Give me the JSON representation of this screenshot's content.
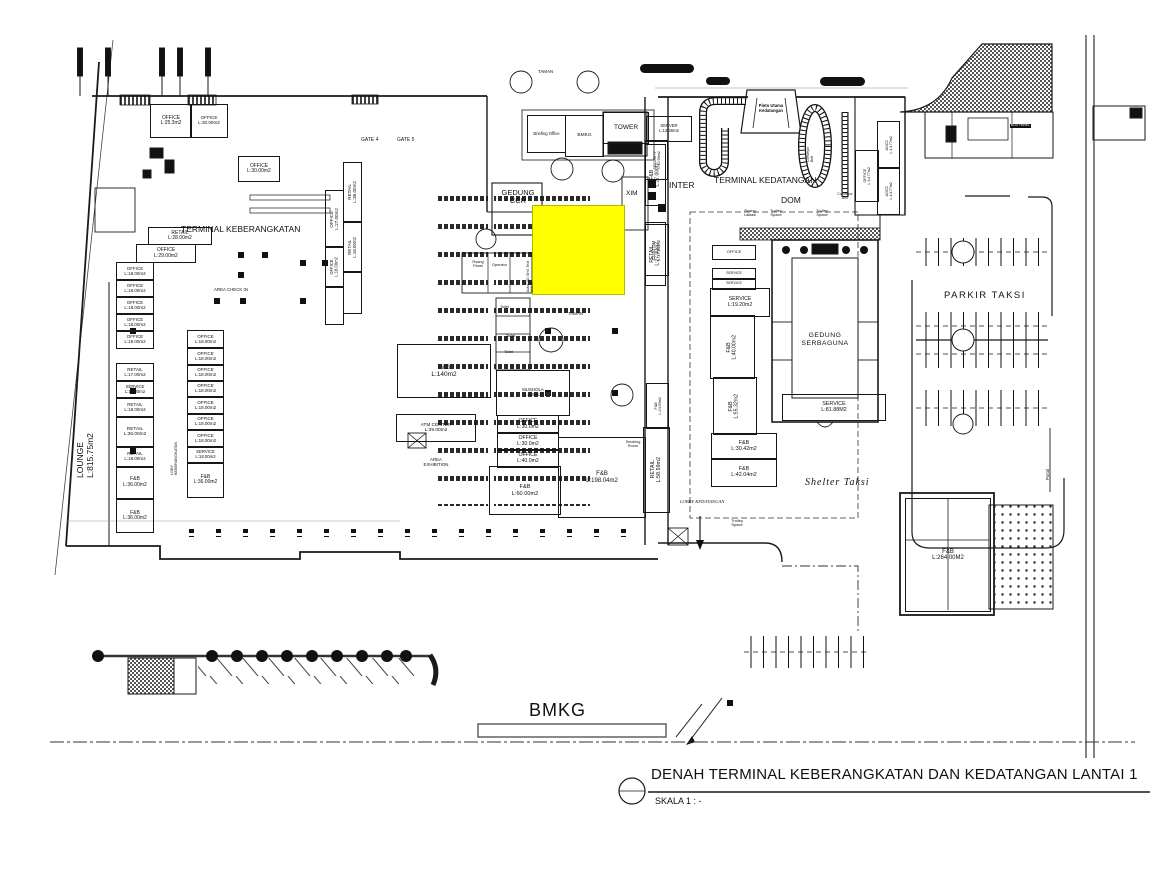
{
  "title_block": {
    "title": "DENAH  TERMINAL KEBERANGKATAN DAN KEDATANGAN LANTAI 1",
    "scale": "SKALA 1 : -"
  },
  "highlight": {
    "x": 532,
    "y": 205,
    "w": 91,
    "h": 88,
    "color": "#ffff00"
  },
  "rooms": [
    {
      "name": "OFFICE",
      "area": "L:25.3m2",
      "x": 150,
      "y": 104,
      "w": 40,
      "h": 32,
      "fs": 5
    },
    {
      "name": "OFFICE",
      "area": "L:30.00m2",
      "x": 190,
      "y": 104,
      "w": 36,
      "h": 32,
      "fs": 4.6
    },
    {
      "name": "OFFICE",
      "area": "L:30.00m2",
      "x": 238,
      "y": 156,
      "w": 40,
      "h": 24,
      "fs": 5
    },
    {
      "name": "RETAIL",
      "area": "L:28.00m2",
      "x": 148,
      "y": 227,
      "w": 62,
      "h": 16,
      "fs": 5
    },
    {
      "name": "OFFICE",
      "area": "L:29.00m2",
      "x": 136,
      "y": 244,
      "w": 58,
      "h": 17,
      "fs": 5
    },
    {
      "name": "OFFICE",
      "area": "L:18.00m2",
      "x": 116,
      "y": 262,
      "w": 36,
      "h": 17,
      "fs": 4.5
    },
    {
      "name": "OFFICE",
      "area": "L:18.00m2",
      "x": 116,
      "y": 279,
      "w": 36,
      "h": 17,
      "fs": 4.5
    },
    {
      "name": "OFFICE",
      "area": "L:18.00m2",
      "x": 116,
      "y": 296,
      "w": 36,
      "h": 17,
      "fs": 4.5
    },
    {
      "name": "OFFICE",
      "area": "L:18.00m2",
      "x": 116,
      "y": 313,
      "w": 36,
      "h": 17,
      "fs": 4.5
    },
    {
      "name": "OFFICE",
      "area": "L:18.00m2",
      "x": 116,
      "y": 330,
      "w": 36,
      "h": 17,
      "fs": 4.5
    },
    {
      "name": "RETAIL",
      "area": "L:17.00m2",
      "x": 116,
      "y": 363,
      "w": 36,
      "h": 17,
      "fs": 4.5
    },
    {
      "name": "SERVICE",
      "area": "L:18.00m2",
      "x": 116,
      "y": 380,
      "w": 36,
      "h": 17,
      "fs": 4.3
    },
    {
      "name": "RETAIL",
      "area": "L:18.00m2",
      "x": 116,
      "y": 397,
      "w": 36,
      "h": 19,
      "fs": 4.5
    },
    {
      "name": "RETAIL",
      "area": "L:36.00m2",
      "x": 116,
      "y": 416,
      "w": 36,
      "h": 30,
      "fs": 4.8
    },
    {
      "name": "RETAIL",
      "area": "L:18.00m2",
      "x": 116,
      "y": 446,
      "w": 36,
      "h": 20,
      "fs": 4.5
    },
    {
      "name": "F&B",
      "area": "L:36.00m2",
      "x": 116,
      "y": 466,
      "w": 36,
      "h": 31,
      "fs": 5
    },
    {
      "name": "F&B",
      "area": "L:36.00m2",
      "x": 116,
      "y": 499,
      "w": 36,
      "h": 32,
      "fs": 5
    },
    {
      "name": "OFFICE",
      "area": "L:18.00m2",
      "x": 187,
      "y": 330,
      "w": 35,
      "h": 17,
      "fs": 4.5
    },
    {
      "name": "OFFICE",
      "area": "L:18.00m2",
      "x": 187,
      "y": 347,
      "w": 35,
      "h": 17,
      "fs": 4.5
    },
    {
      "name": "OFFICE",
      "area": "L:18.00m2",
      "x": 187,
      "y": 364,
      "w": 35,
      "h": 16,
      "fs": 4.5
    },
    {
      "name": "OFFICE",
      "area": "L:18.00m2",
      "x": 187,
      "y": 380,
      "w": 35,
      "h": 16,
      "fs": 4.5
    },
    {
      "name": "OFFICE",
      "area": "L:18.00m2",
      "x": 187,
      "y": 396,
      "w": 35,
      "h": 17,
      "fs": 4.5
    },
    {
      "name": "OFFICE",
      "area": "L:18.00m2",
      "x": 187,
      "y": 413,
      "w": 35,
      "h": 16,
      "fs": 4.5
    },
    {
      "name": "OFFICE",
      "area": "L:18.00m2",
      "x": 187,
      "y": 429,
      "w": 35,
      "h": 17,
      "fs": 4.5
    },
    {
      "name": "SERVICE",
      "area": "L:18.00m2",
      "x": 187,
      "y": 446,
      "w": 35,
      "h": 16,
      "fs": 4.3
    },
    {
      "name": "F&B",
      "area": "L:36.00m2",
      "x": 187,
      "y": 462,
      "w": 35,
      "h": 34,
      "fs": 5
    },
    {
      "name": "RETAIL",
      "area": "L:36.00m2",
      "o": "v",
      "x": 343,
      "y": 162,
      "w": 17,
      "h": 58,
      "fs": 4.6
    },
    {
      "name": "OFFICE",
      "area": "L:27.00m2",
      "o": "v",
      "x": 325,
      "y": 190,
      "w": 17,
      "h": 55,
      "fs": 4.6
    },
    {
      "name": "RETAIL",
      "area": "L:18.00m2",
      "o": "v",
      "x": 343,
      "y": 222,
      "w": 17,
      "h": 48,
      "fs": 4.4
    },
    {
      "name": "OFFICE",
      "area": "L:18.00m2",
      "o": "v",
      "x": 325,
      "y": 247,
      "w": 17,
      "h": 38,
      "fs": 4.2
    },
    {
      "name": "",
      "area": "",
      "x": 325,
      "y": 287,
      "w": 17,
      "h": 36,
      "fs": 4
    },
    {
      "name": "",
      "area": "",
      "x": 343,
      "y": 272,
      "w": 17,
      "h": 40,
      "fs": 4
    },
    {
      "name": "F&B",
      "area": "L:27.00m2",
      "o": "v",
      "x": 645,
      "y": 144,
      "w": 19,
      "h": 60,
      "fs": 5
    },
    {
      "name": "RETAIL",
      "area": "L:27.00m2",
      "o": "v",
      "x": 645,
      "y": 222,
      "w": 19,
      "h": 62,
      "fs": 5
    },
    {
      "name": "SERVER",
      "area": "L:13.36m2",
      "x": 646,
      "y": 116,
      "w": 44,
      "h": 24,
      "fs": 4.2
    },
    {
      "name": "SECURITY",
      "area": "L:12.96m2",
      "o": "v",
      "x": 645,
      "y": 140,
      "w": 21,
      "h": 38,
      "fs": 3.7
    },
    {
      "name": "CUSTOM",
      "area": "L:17.86m2",
      "o": "v",
      "x": 645,
      "y": 224,
      "w": 22,
      "h": 50,
      "fs": 4.4
    },
    {
      "name": "AOCC",
      "area": "L:14.77m2",
      "o": "v",
      "x": 877,
      "y": 121,
      "w": 21,
      "h": 46,
      "fs": 3.7
    },
    {
      "name": "AOCC",
      "area": "L:14.77m2",
      "o": "v",
      "x": 877,
      "y": 167,
      "w": 21,
      "h": 46,
      "fs": 3.7
    },
    {
      "name": "OFFICE",
      "area": "L:14.77m2",
      "o": "v",
      "x": 855,
      "y": 150,
      "w": 22,
      "h": 50,
      "fs": 3.7
    },
    {
      "name": "Briefing Office",
      "area": "",
      "x": 527,
      "y": 115,
      "w": 37,
      "h": 36,
      "fs": 4.2
    },
    {
      "name": "BMKG",
      "area": "",
      "x": 565,
      "y": 115,
      "w": 37,
      "h": 40,
      "fs": 4.8
    },
    {
      "name": "TOWER",
      "area": "",
      "x": 603,
      "y": 112,
      "w": 44,
      "h": 30,
      "fs": 6.5
    },
    {
      "name": "OFFICE",
      "area": "",
      "x": 712,
      "y": 245,
      "w": 42,
      "h": 13,
      "fs": 4
    },
    {
      "name": "SERVICE",
      "area": "",
      "x": 712,
      "y": 268,
      "w": 42,
      "h": 10,
      "fs": 3.6
    },
    {
      "name": "SERVICE",
      "area": "",
      "x": 712,
      "y": 278,
      "w": 42,
      "h": 10,
      "fs": 3.6
    },
    {
      "name": "SERVICE",
      "area": "L:19.20m2",
      "x": 710,
      "y": 288,
      "w": 58,
      "h": 27,
      "fs": 5.2
    },
    {
      "name": "F&B",
      "area": "L:40.00m2",
      "o": "v",
      "x": 710,
      "y": 315,
      "w": 43,
      "h": 62,
      "fs": 5.2
    },
    {
      "name": "F&B",
      "area": "L:55.32m2",
      "o": "v",
      "x": 713,
      "y": 377,
      "w": 42,
      "h": 56,
      "fs": 5.2
    },
    {
      "name": "F&B",
      "area": "L:30.42m2",
      "x": 711,
      "y": 433,
      "w": 64,
      "h": 25,
      "fs": 5.4
    },
    {
      "name": "F&B",
      "area": "L:42.04m2",
      "x": 711,
      "y": 458,
      "w": 64,
      "h": 27,
      "fs": 5.4
    },
    {
      "name": "F&B",
      "area": "L:24.93m2",
      "o": "v",
      "x": 646,
      "y": 383,
      "w": 21,
      "h": 44,
      "fs": 3.7
    },
    {
      "name": "RETAIL",
      "area": "L:58.59m2",
      "o": "v",
      "x": 643,
      "y": 427,
      "w": 25,
      "h": 84,
      "fs": 5.4
    },
    {
      "name": "SERVICE",
      "area": "L:81.88M2",
      "x": 782,
      "y": 394,
      "w": 102,
      "h": 25,
      "fs": 5.4
    },
    {
      "name": "F&B",
      "area": "L:140m2",
      "x": 397,
      "y": 344,
      "w": 92,
      "h": 52,
      "fs": 6.5
    },
    {
      "name": "ATM  CENTER",
      "area": "L:39.00m2",
      "x": 396,
      "y": 414,
      "w": 78,
      "h": 26,
      "fs": 4.8
    },
    {
      "name": "MUSHOLA",
      "area": "L:100m2",
      "x": 496,
      "y": 370,
      "w": 72,
      "h": 44,
      "fs": 4.4
    },
    {
      "name": "OFFICE",
      "area": "L:30.0m2",
      "x": 497,
      "y": 415,
      "w": 60,
      "h": 17,
      "fs": 5.2
    },
    {
      "name": "OFFICE",
      "area": "L:30.0m2",
      "x": 497,
      "y": 432,
      "w": 60,
      "h": 17,
      "fs": 5.2
    },
    {
      "name": "OFFICE",
      "area": "L:40.0m2",
      "x": 497,
      "y": 449,
      "w": 60,
      "h": 17,
      "fs": 5.2
    },
    {
      "name": "F&B",
      "area": "L:60.00m2",
      "x": 489,
      "y": 466,
      "w": 70,
      "h": 47,
      "fs": 5.6
    },
    {
      "name": "F&B",
      "area": "L:198.04m2",
      "x": 558,
      "y": 437,
      "w": 86,
      "h": 79,
      "fs": 6
    },
    {
      "name": "F&B",
      "area": "L:264.00M2",
      "x": 905,
      "y": 498,
      "w": 84,
      "h": 112,
      "fs": 6
    }
  ],
  "labels": [
    {
      "n": "terminal-keberangkatan-label",
      "t": "TERMINAL KEBERANGKATAN",
      "x": 181,
      "y": 225,
      "fs": 8.5
    },
    {
      "n": "terminal-kedatangan-label",
      "t": "TERMINAL KEDATANGAN",
      "x": 714,
      "y": 176,
      "fs": 8.5
    },
    {
      "n": "inter-label",
      "t": "INTER",
      "x": 669,
      "y": 181,
      "fs": 8.5
    },
    {
      "n": "dom-label",
      "t": "DOM",
      "x": 781,
      "y": 196,
      "fs": 8.5
    },
    {
      "n": "parkir-taksi-label",
      "t": "PARKIR TAKSI",
      "x": 944,
      "y": 291,
      "fs": 9.5,
      "ls": 1.5
    },
    {
      "n": "shelter-taksi-label",
      "t": "Shelter Taksi",
      "x": 805,
      "y": 477,
      "fs": 10,
      "i": 1,
      "ls": 1
    },
    {
      "n": "lounge-label",
      "t": "LOUNGE\nL:815.75m2",
      "x": 76,
      "y": 478,
      "fs": 8.5,
      "rot": -90
    },
    {
      "n": "gedung-ccr-label",
      "t": "GEDUNG\nCCR",
      "x": 496,
      "y": 189,
      "fs": 7.5,
      "w": 44,
      "c": 1
    },
    {
      "n": "gate-4-label",
      "t": "GATE 4",
      "x": 361,
      "y": 138,
      "fs": 5
    },
    {
      "n": "gate-5-label",
      "t": "GATE 5",
      "x": 397,
      "y": 138,
      "fs": 5
    },
    {
      "n": "bmkg-site-label",
      "t": "BMKG",
      "x": 529,
      "y": 700,
      "fs": 18,
      "ls": 1
    },
    {
      "n": "area-exhibition-label",
      "t": "AREA\nEXHIBITION",
      "x": 416,
      "y": 458,
      "fs": 4.4,
      "c": 1,
      "w": 40
    },
    {
      "n": "area-checkin-label",
      "t": "AREA CHECK IN",
      "x": 214,
      "y": 288,
      "fs": 4.4
    },
    {
      "n": "lobby-kedatangan-label",
      "t": "LOBBY KEDATANGAN",
      "x": 680,
      "y": 499,
      "fs": 4.6,
      "i": 1
    },
    {
      "n": "loby-keberangkatan-label",
      "t": "LOBY\nKEBERANGKATAN",
      "x": 170,
      "y": 475,
      "fs": 3.8,
      "rot": -90
    },
    {
      "n": "trolley-space-label",
      "t": "Trolley\nSpace",
      "x": 724,
      "y": 519,
      "fs": 4,
      "c": 1,
      "w": 26
    },
    {
      "n": "trolley-space-label",
      "t": "Trolley\nSpace",
      "x": 763,
      "y": 209,
      "fs": 4,
      "c": 1,
      "w": 26
    },
    {
      "n": "trolley-space-label",
      "t": "Trolley\nSpace",
      "x": 809,
      "y": 209,
      "fs": 4,
      "c": 1,
      "w": 26
    },
    {
      "n": "ruang-laktasi-label",
      "t": "Ruang\nLaktasi",
      "x": 739,
      "y": 209,
      "fs": 3.8,
      "c": 1,
      "w": 22
    },
    {
      "n": "pintu-utama-label",
      "t": "Pintu Utama\nKedatangan",
      "x": 748,
      "y": 104,
      "fs": 4.2,
      "c": 1,
      "w": 46,
      "b": 1
    },
    {
      "n": "conveyor-belt-label",
      "t": "Conveyor\nBelt",
      "x": 806,
      "y": 162,
      "fs": 3.6,
      "rot": -90
    },
    {
      "n": "conveyor-belt-label",
      "t": "Conveyor\nBelt",
      "x": 830,
      "y": 192,
      "fs": 3.6,
      "c": 1,
      "w": 30
    },
    {
      "n": "taman-label",
      "t": "TAMAN",
      "x": 538,
      "y": 70,
      "fs": 4.4
    },
    {
      "n": "taman-label",
      "t": "TAMAN",
      "x": 568,
      "y": 312,
      "fs": 4.4
    },
    {
      "n": "xim-label",
      "t": "XIM",
      "x": 626,
      "y": 190,
      "fs": 6.5
    },
    {
      "n": "ruang-panel-label",
      "t": "Ruang\nPanel",
      "x": 468,
      "y": 260,
      "fs": 3.8,
      "c": 1,
      "w": 20
    },
    {
      "n": "operator-label",
      "t": "Operator",
      "x": 492,
      "y": 263,
      "fs": 3.8
    },
    {
      "n": "toilet-label",
      "t": "Toilet",
      "x": 500,
      "y": 305,
      "fs": 3.8
    },
    {
      "n": "toilet-label",
      "t": "Toilet",
      "x": 506,
      "y": 334,
      "fs": 3.8
    },
    {
      "n": "toilet-label",
      "t": "Toilet",
      "x": 504,
      "y": 350,
      "fs": 3.8
    },
    {
      "n": "smoking-room-label",
      "t": "Smoking\nRoom",
      "x": 620,
      "y": 440,
      "fs": 3.8,
      "c": 1,
      "w": 26
    },
    {
      "n": "autocad-artifact-label",
      "t": "AutoCAD SHX Text\n618 X",
      "x": 526,
      "y": 292,
      "fs": 3.6,
      "rot": -90
    },
    {
      "n": "portal-label",
      "t": "Portal",
      "x": 1046,
      "y": 480,
      "fs": 4.2,
      "rot": -90
    },
    {
      "n": "gedung-serbaguna-label",
      "t": "GEDUNG\nSERBAGUNA",
      "x": 794,
      "y": 332,
      "fs": 6.8,
      "c": 1,
      "w": 62,
      "ls": 0.5
    },
    {
      "n": "box-panel-label",
      "t": "BOX PANEL",
      "x": 1010,
      "y": 124,
      "fs": 3.4,
      "bg": "#111111"
    }
  ]
}
